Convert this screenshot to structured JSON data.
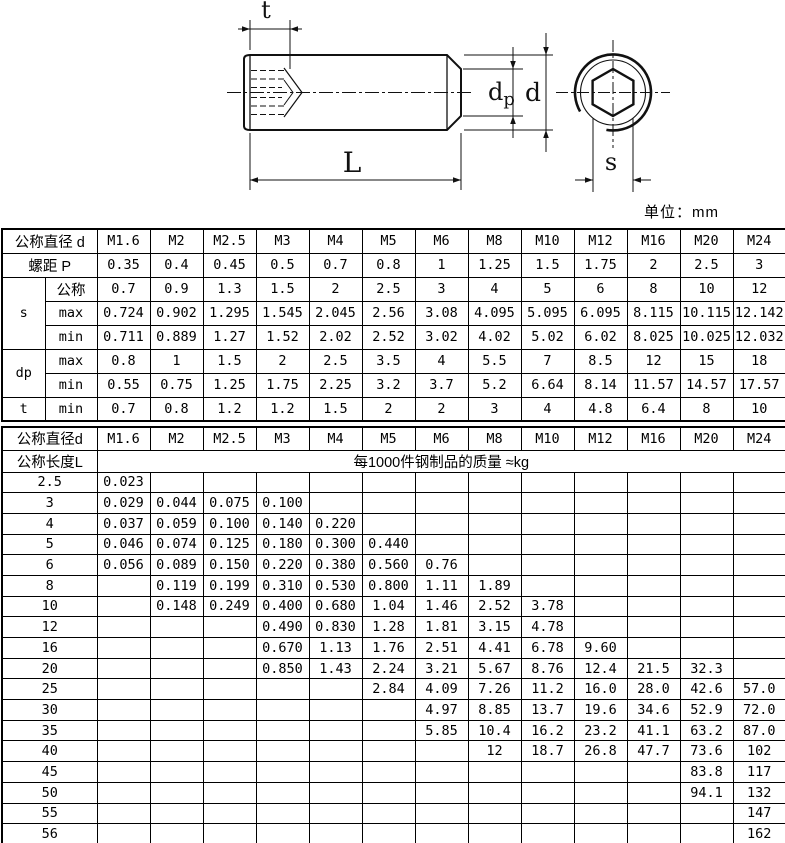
{
  "unit_label": "单位：mm",
  "diagram": {
    "labels": {
      "t": "t",
      "L": "L",
      "d": "d",
      "dp_main": "d",
      "dp_sub": "p",
      "s": "s"
    }
  },
  "spec_table": {
    "diameter_row": {
      "label": "公称直径 d",
      "values": [
        "M1.6",
        "M2",
        "M2.5",
        "M3",
        "M4",
        "M5",
        "M6",
        "M8",
        "M10",
        "M12",
        "M16",
        "M20",
        "M24"
      ]
    },
    "pitch_row": {
      "label": "螺距 P",
      "values": [
        "0.35",
        "0.4",
        "0.45",
        "0.5",
        "0.7",
        "0.8",
        "1",
        "1.25",
        "1.5",
        "1.75",
        "2",
        "2.5",
        "3"
      ]
    },
    "groups": [
      {
        "label": "s",
        "rows": [
          {
            "sub": "公称",
            "values": [
              "0.7",
              "0.9",
              "1.3",
              "1.5",
              "2",
              "2.5",
              "3",
              "4",
              "5",
              "6",
              "8",
              "10",
              "12"
            ]
          },
          {
            "sub": "max",
            "values": [
              "0.724",
              "0.902",
              "1.295",
              "1.545",
              "2.045",
              "2.56",
              "3.08",
              "4.095",
              "5.095",
              "6.095",
              "8.115",
              "10.115",
              "12.142"
            ]
          },
          {
            "sub": "min",
            "values": [
              "0.711",
              "0.889",
              "1.27",
              "1.52",
              "2.02",
              "2.52",
              "3.02",
              "4.02",
              "5.02",
              "6.02",
              "8.025",
              "10.025",
              "12.032"
            ]
          }
        ]
      },
      {
        "label": "dp",
        "rows": [
          {
            "sub": "max",
            "values": [
              "0.8",
              "1",
              "1.5",
              "2",
              "2.5",
              "3.5",
              "4",
              "5.5",
              "7",
              "8.5",
              "12",
              "15",
              "18"
            ]
          },
          {
            "sub": "min",
            "values": [
              "0.55",
              "0.75",
              "1.25",
              "1.75",
              "2.25",
              "3.2",
              "3.7",
              "5.2",
              "6.64",
              "8.14",
              "11.57",
              "14.57",
              "17.57"
            ]
          }
        ]
      },
      {
        "label": "t",
        "rows": [
          {
            "sub": "min",
            "values": [
              "0.7",
              "0.8",
              "1.2",
              "1.2",
              "1.5",
              "2",
              "2",
              "3",
              "4",
              "4.8",
              "6.4",
              "8",
              "10"
            ]
          }
        ]
      }
    ]
  },
  "weight_table": {
    "diameter_row": {
      "label": "公称直径d",
      "values": [
        "M1.6",
        "M2",
        "M2.5",
        "M3",
        "M4",
        "M5",
        "M6",
        "M8",
        "M10",
        "M12",
        "M16",
        "M20",
        "M24"
      ]
    },
    "length_label": "公称长度L",
    "weight_header": "每1000件钢制品的质量 ≈kg",
    "rows": [
      {
        "length": "2.5",
        "values": [
          "0.023",
          "",
          "",
          "",
          "",
          "",
          "",
          "",
          "",
          "",
          "",
          "",
          ""
        ]
      },
      {
        "length": "3",
        "values": [
          "0.029",
          "0.044",
          "0.075",
          "0.100",
          "",
          "",
          "",
          "",
          "",
          "",
          "",
          "",
          ""
        ]
      },
      {
        "length": "4",
        "values": [
          "0.037",
          "0.059",
          "0.100",
          "0.140",
          "0.220",
          "",
          "",
          "",
          "",
          "",
          "",
          "",
          ""
        ]
      },
      {
        "length": "5",
        "values": [
          "0.046",
          "0.074",
          "0.125",
          "0.180",
          "0.300",
          "0.440",
          "",
          "",
          "",
          "",
          "",
          "",
          ""
        ]
      },
      {
        "length": "6",
        "values": [
          "0.056",
          "0.089",
          "0.150",
          "0.220",
          "0.380",
          "0.560",
          "0.76",
          "",
          "",
          "",
          "",
          "",
          ""
        ]
      },
      {
        "length": "8",
        "values": [
          "",
          "0.119",
          "0.199",
          "0.310",
          "0.530",
          "0.800",
          "1.11",
          "1.89",
          "",
          "",
          "",
          "",
          ""
        ]
      },
      {
        "length": "10",
        "values": [
          "",
          "0.148",
          "0.249",
          "0.400",
          "0.680",
          "1.04",
          "1.46",
          "2.52",
          "3.78",
          "",
          "",
          "",
          ""
        ]
      },
      {
        "length": "12",
        "values": [
          "",
          "",
          "",
          "0.490",
          "0.830",
          "1.28",
          "1.81",
          "3.15",
          "4.78",
          "",
          "",
          "",
          ""
        ]
      },
      {
        "length": "16",
        "values": [
          "",
          "",
          "",
          "0.670",
          "1.13",
          "1.76",
          "2.51",
          "4.41",
          "6.78",
          "9.60",
          "",
          "",
          ""
        ]
      },
      {
        "length": "20",
        "values": [
          "",
          "",
          "",
          "0.850",
          "1.43",
          "2.24",
          "3.21",
          "5.67",
          "8.76",
          "12.4",
          "21.5",
          "32.3",
          ""
        ]
      },
      {
        "length": "25",
        "values": [
          "",
          "",
          "",
          "",
          "",
          "2.84",
          "4.09",
          "7.26",
          "11.2",
          "16.0",
          "28.0",
          "42.6",
          "57.0"
        ]
      },
      {
        "length": "30",
        "values": [
          "",
          "",
          "",
          "",
          "",
          "",
          "4.97",
          "8.85",
          "13.7",
          "19.6",
          "34.6",
          "52.9",
          "72.0"
        ]
      },
      {
        "length": "35",
        "values": [
          "",
          "",
          "",
          "",
          "",
          "",
          "5.85",
          "10.4",
          "16.2",
          "23.2",
          "41.1",
          "63.2",
          "87.0"
        ]
      },
      {
        "length": "40",
        "values": [
          "",
          "",
          "",
          "",
          "",
          "",
          "",
          "12",
          "18.7",
          "26.8",
          "47.7",
          "73.6",
          "102"
        ]
      },
      {
        "length": "45",
        "values": [
          "",
          "",
          "",
          "",
          "",
          "",
          "",
          "",
          "",
          "",
          "",
          "83.8",
          "117"
        ]
      },
      {
        "length": "50",
        "values": [
          "",
          "",
          "",
          "",
          "",
          "",
          "",
          "",
          "",
          "",
          "",
          "94.1",
          "132"
        ]
      },
      {
        "length": "55",
        "values": [
          "",
          "",
          "",
          "",
          "",
          "",
          "",
          "",
          "",
          "",
          "",
          "",
          "147"
        ]
      },
      {
        "length": "56",
        "values": [
          "",
          "",
          "",
          "",
          "",
          "",
          "",
          "",
          "",
          "",
          "",
          "",
          "162"
        ]
      }
    ]
  }
}
